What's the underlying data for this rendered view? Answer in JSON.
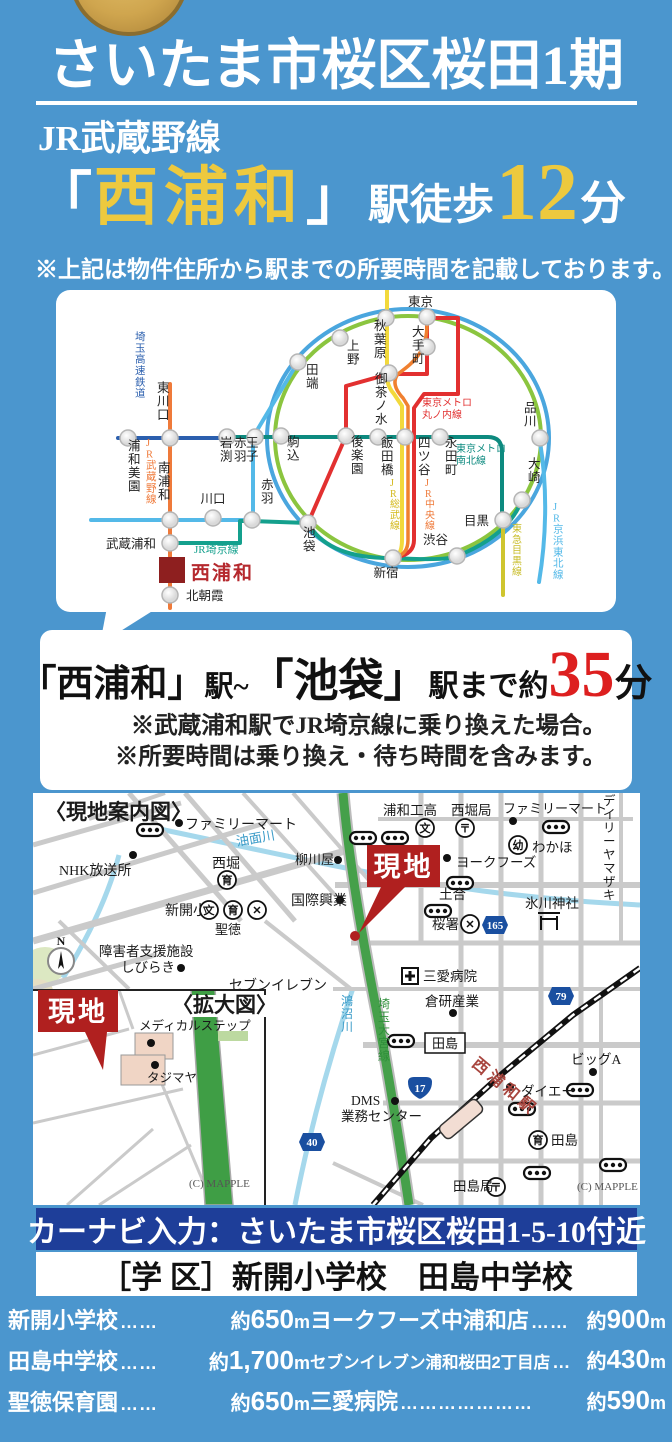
{
  "header": {
    "title": "さいたま市桜区桜田1期",
    "line_name": "JR武蔵野線",
    "bracket_open": "「",
    "station_name": "西浦和",
    "bracket_close": "」",
    "walk_label": "駅徒歩",
    "walk_minutes": "12",
    "walk_unit": "分",
    "note": "※上記は物件住所から駅までの所要時間を記載しております。",
    "accent_yellow": "#edc93e",
    "bg_blue": "#4b96ce"
  },
  "access": {
    "seg1": "「西浦和」",
    "seg2": "駅~",
    "seg3": "「池袋」",
    "seg4": "駅まで約",
    "minutes": "35",
    "unit": "分",
    "minutes_color": "#dd1f1f",
    "notes": [
      "※武蔵浦和駅でJR埼京線に乗り換えた場合。",
      "※所要時間は乗り換え・待ち時間を含みます。"
    ]
  },
  "transit": {
    "ellipses": [
      {
        "cx": 352,
        "cy": 148,
        "rx": 141,
        "ry": 129,
        "c": "#4aa6de",
        "w": 4
      },
      {
        "cx": 352,
        "cy": 148,
        "rx": 133,
        "ry": 122,
        "c": "#8bc53f",
        "w": 4
      }
    ],
    "lines": [
      {
        "name": "saitama-rapid-railway",
        "d": "M62,148 H171",
        "c": "#2b5fae",
        "w": 4
      },
      {
        "name": "metro-namboku",
        "d": "M171,147 H432 Q446,147 446,162 V231",
        "c": "#0d8a7f",
        "w": 4
      },
      {
        "name": "jr-musashino",
        "d": "M114,94 V318",
        "c": "#ef7a3a",
        "w": 4
      },
      {
        "name": "jr-keihin-tohoku",
        "d": "M35,230 H197 V147 L242,72",
        "c": "#54b9e8",
        "w": 4
      },
      {
        "name": "jr-keihin-tohoku-south",
        "d": "M484,152 C492,200 490,250 483,292",
        "c": "#54b9e8",
        "w": 4
      },
      {
        "name": "jr-saikyo",
        "d": "M114,253 H184 V231 H196 L252,233 Q272,269 337,268 Q392,271 401,266 Q452,246 466,210",
        "c": "#14a08d",
        "w": 4
      },
      {
        "name": "metro-marunouchi-a",
        "d": "M252,233 L290,146 V96 L333,84",
        "c": "#e23030",
        "w": 4
      },
      {
        "name": "metro-marunouchi-b",
        "d": "M333,84 H371 V28",
        "c": "#e23030",
        "w": 4
      },
      {
        "name": "metro-marunouchi-c",
        "d": "M371,28 H402 V104 H368 L358,118 V250 Q358,264 341,267",
        "c": "#e23030",
        "w": 4
      },
      {
        "name": "jr-sobu",
        "d": "M331,0 V86 Q331,96 338,104 L346,116 V250 Q346,264 339,267",
        "c": "#f2d93c",
        "w": 4
      },
      {
        "name": "jr-chuo",
        "d": "M371,34 C371,64 355,74 342,84 Q334,94 347,108 L352,116 V250 Q352,264 340,267",
        "c": "#f08030",
        "w": 3.5
      },
      {
        "name": "tokyu-meguro",
        "d": "M447,232 V305",
        "c": "#cfc52e",
        "w": 4
      }
    ],
    "stations": [
      [
        72,
        148
      ],
      [
        114,
        148
      ],
      [
        171,
        147
      ],
      [
        199,
        147
      ],
      [
        225,
        146
      ],
      [
        290,
        146
      ],
      [
        322,
        147
      ],
      [
        349,
        147
      ],
      [
        384,
        147
      ],
      [
        242,
        72
      ],
      [
        284,
        48
      ],
      [
        330,
        28
      ],
      [
        371,
        27
      ],
      [
        371,
        57
      ],
      [
        333,
        83
      ],
      [
        484,
        148
      ],
      [
        466,
        210
      ],
      [
        447,
        230
      ],
      [
        401,
        266
      ],
      [
        337,
        268
      ],
      [
        252,
        233
      ],
      [
        114,
        230
      ],
      [
        157,
        228
      ],
      [
        196,
        230
      ],
      [
        114,
        253
      ],
      [
        114,
        305
      ]
    ],
    "labels": [
      {
        "t": "浦和美園",
        "x": 72,
        "y": 160,
        "d": "v"
      },
      {
        "t": "東川口",
        "x": 101,
        "y": 102,
        "d": "v"
      },
      {
        "t": "赤羽",
        "x": 178,
        "y": 157,
        "d": "v"
      },
      {
        "t": "岩渕",
        "x": 164,
        "y": 157,
        "d": "v"
      },
      {
        "t": "王子",
        "x": 190,
        "y": 157,
        "d": "v"
      },
      {
        "t": "駒込",
        "x": 231,
        "y": 156,
        "d": "v"
      },
      {
        "t": "後楽園",
        "x": 295,
        "y": 156,
        "d": "v"
      },
      {
        "t": "飯田橋",
        "x": 325,
        "y": 157,
        "d": "v"
      },
      {
        "t": "四ツ谷",
        "x": 362,
        "y": 157,
        "d": "v"
      },
      {
        "t": "永田町",
        "x": 389,
        "y": 157,
        "d": "v"
      },
      {
        "t": "田端",
        "x": 250,
        "y": 84,
        "d": "v"
      },
      {
        "t": "上野",
        "x": 291,
        "y": 60,
        "d": "v"
      },
      {
        "t": "秋葉原",
        "x": 318,
        "y": 40,
        "d": "v"
      },
      {
        "t": "東京",
        "x": 352,
        "y": 16,
        "d": "h",
        "a": "start"
      },
      {
        "t": "大手町",
        "x": 356,
        "y": 46,
        "d": "v"
      },
      {
        "t": "御茶ノ水",
        "x": 319,
        "y": 93,
        "d": "v"
      },
      {
        "t": "品川",
        "x": 468,
        "y": 122,
        "d": "v"
      },
      {
        "t": "大崎",
        "x": 472,
        "y": 178,
        "d": "v"
      },
      {
        "t": "目黒",
        "x": 433,
        "y": 235,
        "d": "h",
        "a": "end"
      },
      {
        "t": "渋谷",
        "x": 392,
        "y": 254,
        "d": "h",
        "a": "end"
      },
      {
        "t": "新宿",
        "x": 330,
        "y": 287,
        "d": "h",
        "a": "middle"
      },
      {
        "t": "池袋",
        "x": 247,
        "y": 247,
        "d": "v"
      },
      {
        "t": "南浦和",
        "x": 102,
        "y": 182,
        "d": "v"
      },
      {
        "t": "川口",
        "x": 157,
        "y": 213,
        "d": "h",
        "a": "middle"
      },
      {
        "t": "赤羽",
        "x": 205,
        "y": 199,
        "d": "v"
      },
      {
        "t": "武蔵浦和",
        "x": 100,
        "y": 258,
        "d": "h",
        "a": "end"
      },
      {
        "t": "北朝霞",
        "x": 130,
        "y": 310,
        "d": "h",
        "a": "start"
      },
      {
        "t": "埼玉高速鉄道",
        "x": 79,
        "y": 50,
        "d": "v",
        "c": "#2b5fae",
        "s": 10.5
      },
      {
        "t": "JR武蔵野線",
        "x": 90,
        "y": 156,
        "d": "v",
        "c": "#ef7a3a",
        "s": 10.5
      },
      {
        "t": "JR埼京線",
        "x": 138,
        "y": 263,
        "d": "h",
        "a": "start",
        "c": "#14a08d",
        "s": 11
      },
      {
        "t": "東京メトロ",
        "x": 366,
        "y": 116,
        "d": "h",
        "a": "start",
        "c": "#e23030",
        "s": 10
      },
      {
        "t": "丸ノ内線",
        "x": 366,
        "y": 128,
        "d": "h",
        "a": "start",
        "c": "#e23030",
        "s": 10
      },
      {
        "t": "東京メトロ",
        "x": 400,
        "y": 162,
        "d": "h",
        "a": "start",
        "c": "#0d8a7f",
        "s": 10
      },
      {
        "t": "南北線",
        "x": 400,
        "y": 174,
        "d": "h",
        "a": "start",
        "c": "#0d8a7f",
        "s": 10
      },
      {
        "t": "JR総武線",
        "x": 334,
        "y": 196,
        "d": "v",
        "c": "#d4b91c",
        "s": 10
      },
      {
        "t": "JR中央線",
        "x": 369,
        "y": 196,
        "d": "v",
        "c": "#ef7a3a",
        "s": 10
      },
      {
        "t": "JR京浜東北線",
        "x": 497,
        "y": 220,
        "d": "v",
        "c": "#54b9e8",
        "s": 10.5
      },
      {
        "t": "東急目黒線",
        "x": 456,
        "y": 242,
        "d": "v",
        "c": "#c9bd2a",
        "s": 10
      }
    ],
    "highlight": {
      "t": "西浦和",
      "x": 103,
      "y": 267,
      "w": 26,
      "h": 26,
      "box": "#8e1f1f",
      "c": "#b5292e",
      "lx": 135,
      "ly": 289,
      "s": 19
    }
  },
  "map": {
    "title": "〈現地案内図〉",
    "inset_title": "〈拡大図〉",
    "site_label": "現地",
    "site_color": "#b0201f",
    "credit": "(C) MAPPLE",
    "labels": [
      {
        "t": "〈現地案内図〉",
        "x": 12,
        "y": 26,
        "s": 21,
        "b": 1
      },
      {
        "t": "ファミリーマート",
        "x": 152,
        "y": 36,
        "s": 14
      },
      {
        "t": "油面川",
        "x": 204,
        "y": 53,
        "s": 13,
        "c": "#3a9bc8",
        "rot": -10
      },
      {
        "t": "NHK放送所",
        "x": 26,
        "y": 82,
        "s": 14
      },
      {
        "t": "西堀",
        "x": 179,
        "y": 75,
        "s": 14
      },
      {
        "t": "柳川屋",
        "x": 262,
        "y": 71,
        "s": 13
      },
      {
        "t": "国際興業",
        "x": 258,
        "y": 112,
        "s": 14
      },
      {
        "t": "新開小",
        "x": 132,
        "y": 122,
        "s": 14
      },
      {
        "t": "聖徳",
        "x": 182,
        "y": 141,
        "s": 13
      },
      {
        "t": "障害者支援施設",
        "x": 66,
        "y": 163,
        "s": 13.5
      },
      {
        "t": "しびらき",
        "x": 88,
        "y": 179,
        "s": 13.5
      },
      {
        "t": "セブンイレブン",
        "x": 196,
        "y": 197,
        "s": 14
      },
      {
        "t": "〈拡大図〉",
        "x": 139,
        "y": 219,
        "s": 21,
        "b": 1,
        "plate": 1
      },
      {
        "t": "メディカルステップ",
        "x": 106,
        "y": 237,
        "s": 12.5
      },
      {
        "t": "タジマヤ",
        "x": 114,
        "y": 289,
        "s": 12.5
      },
      {
        "t": "(C) MAPPLE",
        "x": 156,
        "y": 394,
        "s": 11,
        "c": "#555"
      },
      {
        "t": "浦和工高",
        "x": 350,
        "y": 22,
        "s": 13.5
      },
      {
        "t": "西堀局",
        "x": 418,
        "y": 22,
        "s": 13.5
      },
      {
        "t": "ファミリーマート",
        "x": 470,
        "y": 20,
        "s": 13
      },
      {
        "t": "わかほ",
        "x": 499,
        "y": 59,
        "s": 13.5
      },
      {
        "t": "デイリーヤマザキ",
        "x": 570,
        "y": 12,
        "s": 12.5,
        "d": "v"
      },
      {
        "t": "ヨークフーズ",
        "x": 423,
        "y": 74,
        "s": 13.5
      },
      {
        "t": "土合",
        "x": 406,
        "y": 106,
        "s": 13.5
      },
      {
        "t": "桜署",
        "x": 399,
        "y": 136,
        "s": 13.5
      },
      {
        "t": "氷川神社",
        "x": 492,
        "y": 115,
        "s": 13.5
      },
      {
        "t": "三愛病院",
        "x": 390,
        "y": 188,
        "s": 13.5
      },
      {
        "t": "倉研産業",
        "x": 392,
        "y": 213,
        "s": 13.5
      },
      {
        "t": "鴻沼川",
        "x": 308,
        "y": 212,
        "s": 12,
        "c": "#3a9bc8",
        "d": "v"
      },
      {
        "t": "埼玉大宮線",
        "x": 345,
        "y": 215,
        "s": 12,
        "c": "#2f8f3a",
        "d": "v"
      },
      {
        "t": "西浦和駅",
        "x": 438,
        "y": 272,
        "s": 16,
        "c": "#a8453e",
        "rot": 40,
        "b": 1,
        "sp": 4
      },
      {
        "t": "ビッグA",
        "x": 538,
        "y": 271,
        "s": 13.5
      },
      {
        "t": "ダイエー",
        "x": 488,
        "y": 303,
        "s": 13.5
      },
      {
        "t": "DMS",
        "x": 318,
        "y": 312,
        "s": 13.5
      },
      {
        "t": "業務センター",
        "x": 308,
        "y": 328,
        "s": 13.5
      },
      {
        "t": "田島",
        "x": 518,
        "y": 352,
        "s": 13.5
      },
      {
        "t": "田島局",
        "x": 420,
        "y": 398,
        "s": 13.5
      },
      {
        "t": "(C) MAPPLE",
        "x": 544,
        "y": 397,
        "s": 11,
        "c": "#555"
      }
    ],
    "boxed_labels": [
      {
        "t": "田島",
        "x": 392,
        "y": 240,
        "w": 40,
        "h": 20
      }
    ],
    "icons": [
      {
        "k": "circ",
        "ch": "文",
        "x": 176,
        "y": 117
      },
      {
        "k": "circ",
        "ch": "文",
        "x": 392,
        "y": 35
      },
      {
        "k": "circ",
        "ch": "育",
        "x": 194,
        "y": 87
      },
      {
        "k": "circ",
        "ch": "育",
        "x": 200,
        "y": 117
      },
      {
        "k": "circ",
        "ch": "育",
        "x": 505,
        "y": 347
      },
      {
        "k": "circ",
        "ch": "幼",
        "x": 485,
        "y": 52
      },
      {
        "k": "circ",
        "ch": "〒",
        "x": 432,
        "y": 35
      },
      {
        "k": "circ",
        "ch": "〒",
        "x": 463,
        "y": 394
      },
      {
        "k": "circ",
        "ch": "✕",
        "x": 224,
        "y": 117
      },
      {
        "k": "circ",
        "ch": "✕",
        "x": 437,
        "y": 131
      },
      {
        "k": "hosp",
        "x": 377,
        "y": 183
      },
      {
        "k": "torii",
        "x": 516,
        "y": 127
      },
      {
        "k": "dot",
        "x": 146,
        "y": 30
      },
      {
        "k": "dot",
        "x": 100,
        "y": 62
      },
      {
        "k": "dot",
        "x": 305,
        "y": 67
      },
      {
        "k": "dot",
        "x": 307,
        "y": 107
      },
      {
        "k": "dot",
        "x": 148,
        "y": 175
      },
      {
        "k": "dot",
        "x": 480,
        "y": 28
      },
      {
        "k": "dot",
        "x": 414,
        "y": 65
      },
      {
        "k": "dot",
        "x": 560,
        "y": 279
      },
      {
        "k": "dot",
        "x": 477,
        "y": 294
      },
      {
        "k": "dot",
        "x": 362,
        "y": 308
      },
      {
        "k": "dot",
        "x": 420,
        "y": 220
      },
      {
        "k": "dot",
        "x": 118,
        "y": 250
      },
      {
        "k": "dot",
        "x": 122,
        "y": 272
      },
      {
        "k": "bus",
        "x": 117,
        "y": 37
      },
      {
        "k": "bus",
        "x": 330,
        "y": 45
      },
      {
        "k": "bus",
        "x": 362,
        "y": 45
      },
      {
        "k": "bus",
        "x": 523,
        "y": 34
      },
      {
        "k": "bus",
        "x": 427,
        "y": 90
      },
      {
        "k": "bus",
        "x": 405,
        "y": 118
      },
      {
        "k": "bus",
        "x": 368,
        "y": 248
      },
      {
        "k": "bus",
        "x": 547,
        "y": 297
      },
      {
        "k": "bus",
        "x": 489,
        "y": 316
      },
      {
        "k": "bus",
        "x": 580,
        "y": 372
      },
      {
        "k": "bus",
        "x": 504,
        "y": 380
      },
      {
        "k": "compass",
        "x": 28,
        "y": 168
      }
    ],
    "shields": [
      {
        "n": "165",
        "x": 462,
        "y": 132,
        "type": "hex"
      },
      {
        "n": "79",
        "x": 528,
        "y": 203,
        "type": "hex"
      },
      {
        "n": "17",
        "x": 387,
        "y": 295,
        "type": "oni"
      },
      {
        "n": "40",
        "x": 279,
        "y": 349,
        "type": "hex"
      }
    ],
    "sites": [
      {
        "x": 5,
        "y": 197,
        "w": 80,
        "h": 42,
        "tail": [
          [
            52,
            239
          ],
          [
            74,
            239
          ],
          [
            70,
            277
          ]
        ]
      },
      {
        "x": 334,
        "y": 52,
        "w": 73,
        "h": 42,
        "tail": [
          [
            348,
            94
          ],
          [
            372,
            94
          ],
          [
            326,
            140
          ]
        ],
        "dot": [
          322,
          143
        ]
      }
    ]
  },
  "navi_bar": {
    "text": "カーナビ入力：さいたま市桜区桜田1-5-10付近",
    "bg": "#1e3e99"
  },
  "school_bar": {
    "text": "［学 区］新開小学校　田島中学校"
  },
  "distances": {
    "left": [
      {
        "name": "新開小学校",
        "leader": "…… ",
        "pre": "約",
        "num": "650",
        "unit": "m"
      },
      {
        "name": "田島中学校",
        "leader": "…… ",
        "pre": "約",
        "num": "1,700",
        "unit": "m"
      },
      {
        "name": "聖徳保育園",
        "leader": "…… ",
        "pre": "約",
        "num": "650",
        "unit": "m"
      }
    ],
    "right": [
      {
        "name": "ヨークフーズ中浦和店",
        "leader": "……",
        "pre": "約",
        "num": "900",
        "unit": "m"
      },
      {
        "name": "セブンイレブン浦和桜田2丁目店",
        "leader": "…",
        "pre": "約",
        "num": "430",
        "unit": "m",
        "compact": true
      },
      {
        "name": "三愛病院",
        "leader": "…………………",
        "pre": "約",
        "num": "590",
        "unit": "m"
      }
    ]
  }
}
